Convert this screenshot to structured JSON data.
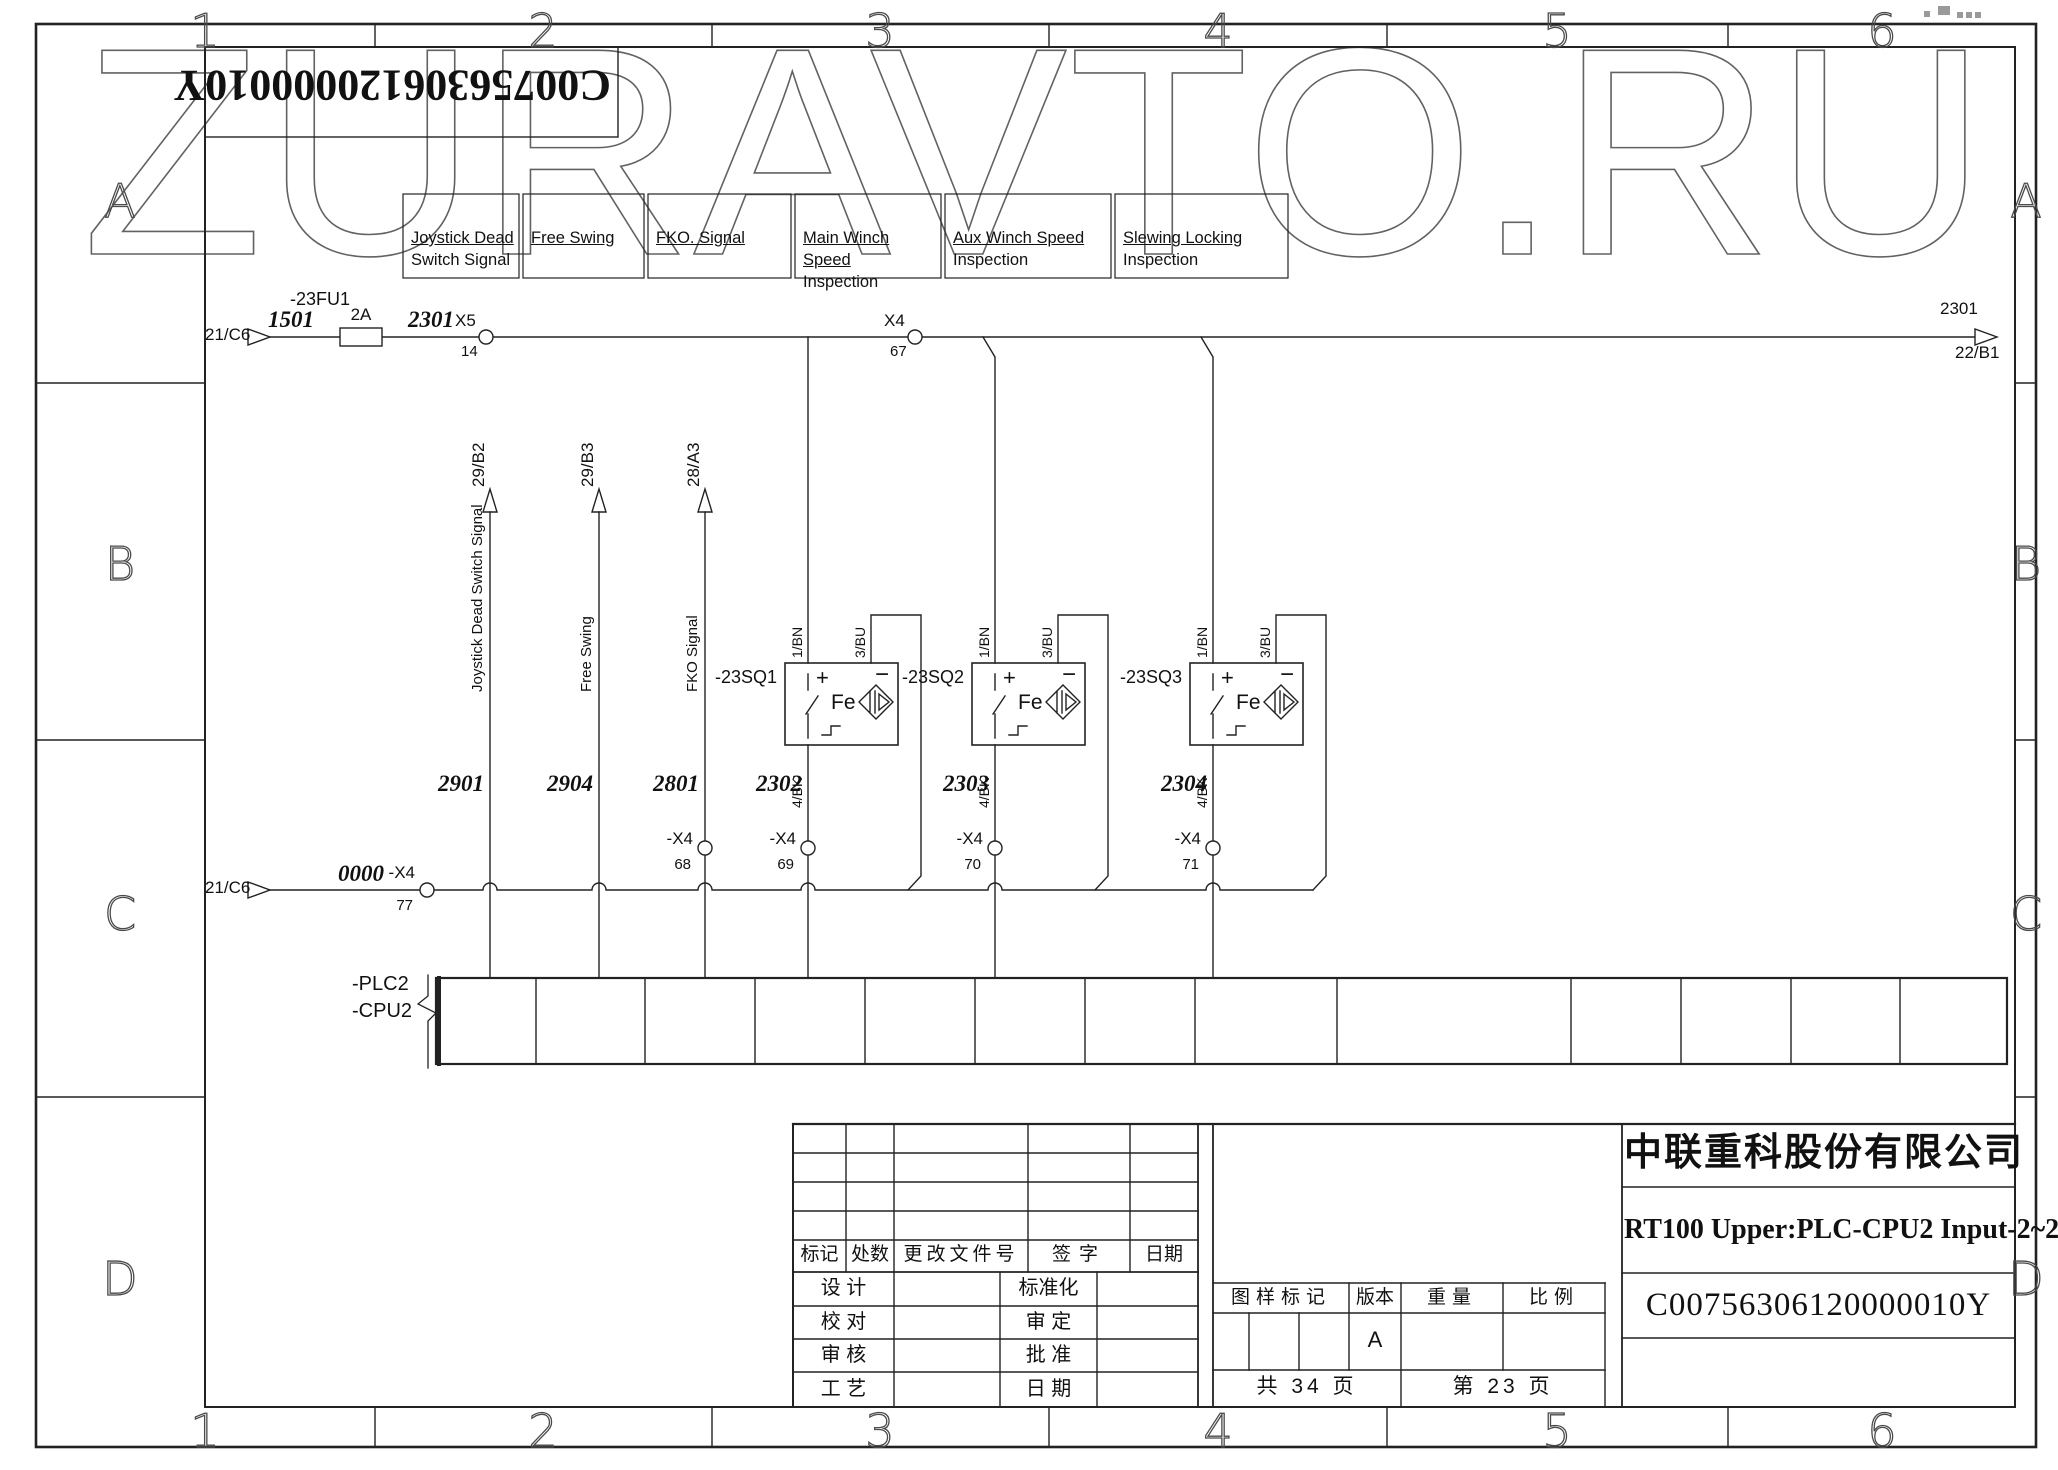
{
  "watermark": "ZURAVTO.RU",
  "mirrored_id": "C00756306120000010Y",
  "frame": {
    "cols": [
      "1",
      "2",
      "3",
      "4",
      "5",
      "6"
    ],
    "rows": [
      "A",
      "B",
      "C",
      "D"
    ]
  },
  "signal_boxes": [
    {
      "line1": "Joystick Dead",
      "line2": "Switch Signal"
    },
    {
      "line1": "Free Swing",
      "line2": ""
    },
    {
      "line1": "FKO. Signal",
      "line2": ""
    },
    {
      "line1": "Main Winch Speed",
      "line2": "Inspection"
    },
    {
      "line1": "Aux Winch Speed",
      "line2": "Inspection"
    },
    {
      "line1": "Slewing Locking",
      "line2": "Inspection"
    }
  ],
  "top_bus": {
    "left_ref": "21/C6",
    "wire_in": "1501",
    "fuse_tag": "-23FU1",
    "fuse_rating": "2A",
    "wire_out": "2301",
    "x5_name": "X5",
    "x5_pin": "14",
    "x4_name": "X4",
    "x4_pin": "67",
    "right_wire": "2301",
    "right_ref": "22/B1"
  },
  "branches": [
    {
      "dest": "29/B2",
      "name": "Joystick Dead Switch Signal",
      "wire": "2901"
    },
    {
      "dest": "29/B3",
      "name": "Free Swing",
      "wire": "2904"
    },
    {
      "dest": "28/A3",
      "name": "FKO Signal",
      "wire": "2801",
      "conn": "-X4",
      "pin": "68"
    }
  ],
  "sensors": [
    {
      "tag": "-23SQ1",
      "plus": "+",
      "minus": "−",
      "core": "Fe",
      "bn": "1/BN",
      "bu": "3/BU",
      "bk": "4/BK",
      "wire": "2302",
      "conn": "-X4",
      "pin": "69"
    },
    {
      "tag": "-23SQ2",
      "plus": "+",
      "minus": "−",
      "core": "Fe",
      "bn": "1/BN",
      "bu": "3/BU",
      "bk": "4/BK",
      "wire": "2303",
      "conn": "-X4",
      "pin": "70"
    },
    {
      "tag": "-23SQ3",
      "plus": "+",
      "minus": "−",
      "core": "Fe",
      "bn": "1/BN",
      "bu": "3/BU",
      "bk": "4/BK",
      "wire": "2304",
      "conn": "-X4",
      "pin": "71"
    }
  ],
  "bottom_bus": {
    "left_ref": "21/C6",
    "wire": "0000",
    "conn": "-X4",
    "pin": "77"
  },
  "plc": {
    "tag1": "-PLC2",
    "tag2": "-CPU2"
  },
  "title_block": {
    "company": "中联重科股份有限公司",
    "doc_title": "RT100 Upper:PLC-CPU2 Input-2~2",
    "drawing_no": "C00756306120000010Y",
    "rev_headers": [
      "标记",
      "处数",
      "更改文件号",
      "签字",
      "日期"
    ],
    "sign_rows": [
      [
        "设 计",
        "标准化"
      ],
      [
        "校 对",
        "审 定"
      ],
      [
        "审 核",
        "批 准"
      ],
      [
        "工 艺",
        "日 期"
      ]
    ],
    "stamp": {
      "mark_label": "图样标记",
      "version_label": "版本",
      "weight_label": "重量",
      "scale_label": "比例",
      "version": "A",
      "pages_total": "共 34 页",
      "page_current": "第 23 页"
    }
  }
}
